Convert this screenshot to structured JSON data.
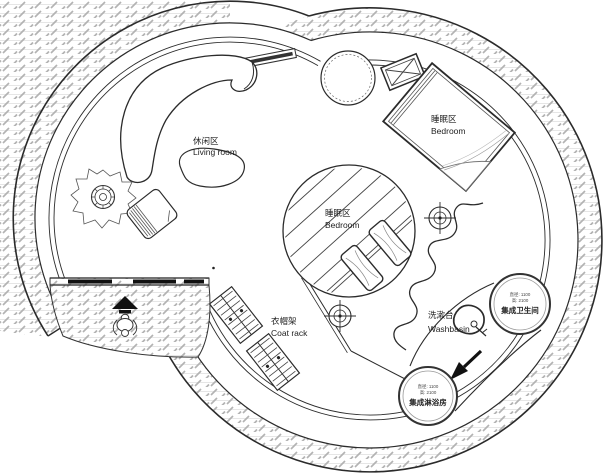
{
  "plan": {
    "type": "floor-plan",
    "rooms": {
      "living_room": {
        "zh": "休闲区",
        "en": "Living room"
      },
      "bedroom_upper": {
        "zh": "睡眠区",
        "en": "Bedroom"
      },
      "bedroom_center": {
        "zh": "睡眠区",
        "en": "Bedroom"
      },
      "coat_rack": {
        "zh": "衣帽架",
        "en": "Coat rack"
      },
      "washbasin": {
        "zh": "洗漱台",
        "en": "Washbasin"
      }
    },
    "pods": {
      "bathroom": {
        "name": "集成卫生间",
        "dim_diameter": "直径: 1100",
        "dim_height": "高: 2100"
      },
      "shower": {
        "name": "集成淋浴房",
        "dim_diameter": "直径: 1100",
        "dim_height": "高: 2100"
      }
    },
    "colors": {
      "line": "#2b2b2b",
      "hatch_tick": "#b3b3b3",
      "hatch_course": "#dcdcdc",
      "door_fill": "#111111",
      "background": "#ffffff"
    }
  }
}
